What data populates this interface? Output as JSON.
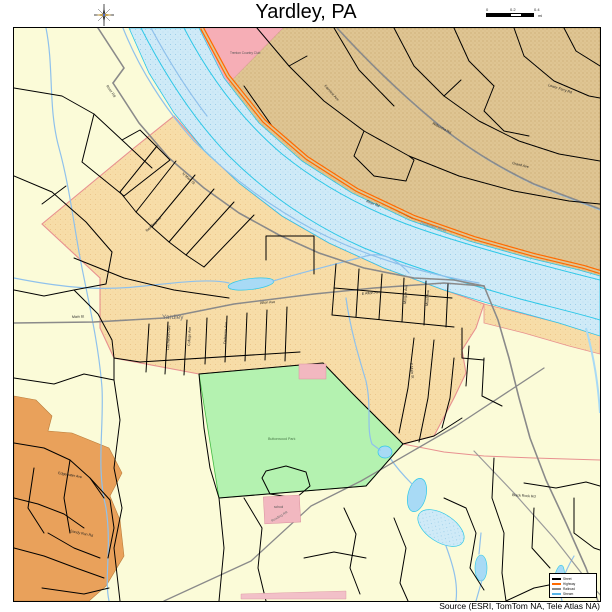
{
  "header": {
    "title": "Yardley, PA"
  },
  "compass": {
    "icon": "compass-rose-icon"
  },
  "scalebar": {
    "ticks": [
      "0",
      "0.2",
      "0.4"
    ],
    "unit": "mi"
  },
  "footer": {
    "source": "Source (ESRI, TomTom NA, Tele Atlas NA)"
  },
  "legend": {
    "items": [
      {
        "label": "Street",
        "color": "#000000"
      },
      {
        "label": "Highway",
        "color": "#ff6a00"
      },
      {
        "label": "Railroad",
        "color": "#8a8a8a"
      },
      {
        "label": "Stream",
        "color": "#58b5e8"
      }
    ]
  },
  "map": {
    "colors": {
      "township_cream": "#fbfbd8",
      "borough_tan": "#f7dda8",
      "nj_tan": "#dfc593",
      "dev_orange": "#e9a15b",
      "park_green": "#b4f2b0",
      "river_blue": "#cfeaf7",
      "river_channel": "#2ec8e8",
      "stream_blue": "#8fc1ec",
      "lake_blue": "#a8daf5",
      "pink_area": "#f6aeb6",
      "building_pink": "#f2b8c0",
      "boundary_salmon": "#e89090",
      "highway_orange": "#ff6a00",
      "major_road_gray": "#8a8a8a",
      "road_black": "#000000"
    },
    "labels": [
      {
        "t": "Yardley",
        "x": 148,
        "y": 291,
        "r": 0,
        "k": "place"
      },
      {
        "t": "N Main St",
        "x": 168,
        "y": 146,
        "r": 42,
        "k": "street"
      },
      {
        "t": "S Main St",
        "x": 396,
        "y": 335,
        "r": 84,
        "k": "street"
      },
      {
        "t": "Main St",
        "x": 58,
        "y": 290,
        "r": -2,
        "k": "street"
      },
      {
        "t": "Afton Ave",
        "x": 246,
        "y": 276,
        "r": -4,
        "k": "street"
      },
      {
        "t": "E Afton Ave",
        "x": 348,
        "y": 267,
        "r": -6,
        "k": "street"
      },
      {
        "t": "River Rd",
        "x": 92,
        "y": 58,
        "r": 55,
        "k": "street"
      },
      {
        "t": "Delaware Ave",
        "x": 212,
        "y": 316,
        "r": -87,
        "k": "street"
      },
      {
        "t": "College Ave",
        "x": 176,
        "y": 318,
        "r": -87,
        "k": "street"
      },
      {
        "t": "Letchworth Ave",
        "x": 155,
        "y": 322,
        "r": -87,
        "k": "street"
      },
      {
        "t": "Reading Ave",
        "x": 133,
        "y": 204,
        "r": -44,
        "k": "street"
      },
      {
        "t": "Edgewater Ave",
        "x": 44,
        "y": 446,
        "r": 10,
        "k": "street"
      },
      {
        "t": "Sandy Run Rd",
        "x": 56,
        "y": 504,
        "r": 12,
        "k": "street"
      },
      {
        "t": "Mead Ave",
        "x": 414,
        "y": 278,
        "r": -86,
        "k": "street"
      },
      {
        "t": "Morgan Ave",
        "x": 392,
        "y": 276,
        "r": -86,
        "k": "street"
      },
      {
        "t": "Black Rock Rd",
        "x": 498,
        "y": 468,
        "r": 4,
        "k": "street"
      },
      {
        "t": "River Rd",
        "x": 352,
        "y": 174,
        "r": 22,
        "k": "street"
      },
      {
        "t": "Wilburtha Rd",
        "x": 418,
        "y": 96,
        "r": 28,
        "k": "street"
      },
      {
        "t": "Grand Ave",
        "x": 498,
        "y": 136,
        "r": 14,
        "k": "street"
      },
      {
        "t": "Lower Ferry Rd",
        "x": 534,
        "y": 58,
        "r": 18,
        "k": "street"
      },
      {
        "t": "Fairview Ave",
        "x": 310,
        "y": 58,
        "r": 48,
        "k": "street"
      },
      {
        "t": "Delaware River",
        "x": 406,
        "y": 196,
        "r": 17,
        "k": "water"
      },
      {
        "t": "Buttonwood Park",
        "x": 254,
        "y": 412,
        "r": 0,
        "k": "park"
      },
      {
        "t": "Reading RR",
        "x": 258,
        "y": 494,
        "r": -30,
        "k": "rail"
      },
      {
        "t": "Trenton Country Club",
        "x": 216,
        "y": 26,
        "r": 0,
        "k": "tiny"
      },
      {
        "t": "school",
        "x": 260,
        "y": 480,
        "r": 0,
        "k": "tiny"
      }
    ]
  }
}
